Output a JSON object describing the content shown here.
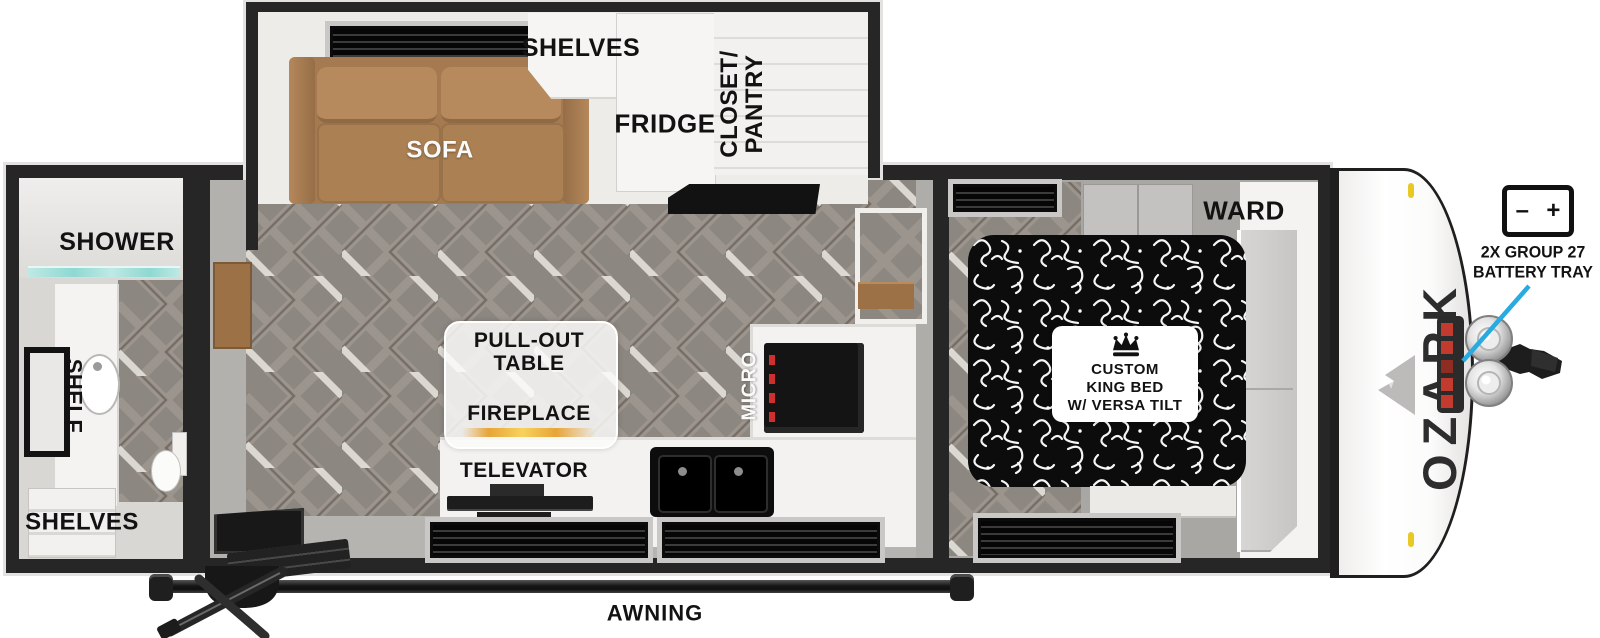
{
  "floorplan": {
    "brand_logo": "OZARK",
    "rear_bath": {
      "shower": "SHOWER",
      "shelf": "SHELF",
      "shelves": "SHELVES"
    },
    "slideout": {
      "sofa": "SOFA",
      "shelves": "SHELVES",
      "fridge": "FRIDGE",
      "closet_line1": "CLOSET/",
      "closet_line2": "PANTRY"
    },
    "kitchen": {
      "pullout_line1": "PULL-OUT",
      "pullout_line2": "TABLE",
      "fireplace": "FIREPLACE",
      "televator": "TELEVATOR",
      "micro": "MICRO"
    },
    "bedroom": {
      "ward": "WARD",
      "bed_line1": "CUSTOM",
      "bed_line2": "KING BED",
      "bed_line3": "W/ VERSA TILT"
    },
    "exterior": {
      "awning": "AWNING",
      "battery_line1": "2X GROUP 27",
      "battery_line2": "BATTERY TRAY",
      "battery_minus": "–",
      "battery_plus": "+"
    }
  },
  "colors": {
    "callout": "#29abe2",
    "sofa": "#a97e55",
    "wood": "#9c7146",
    "marker_light": "#e8c824",
    "battery_tray_red": "#c23b2e",
    "wall": "#262626"
  }
}
